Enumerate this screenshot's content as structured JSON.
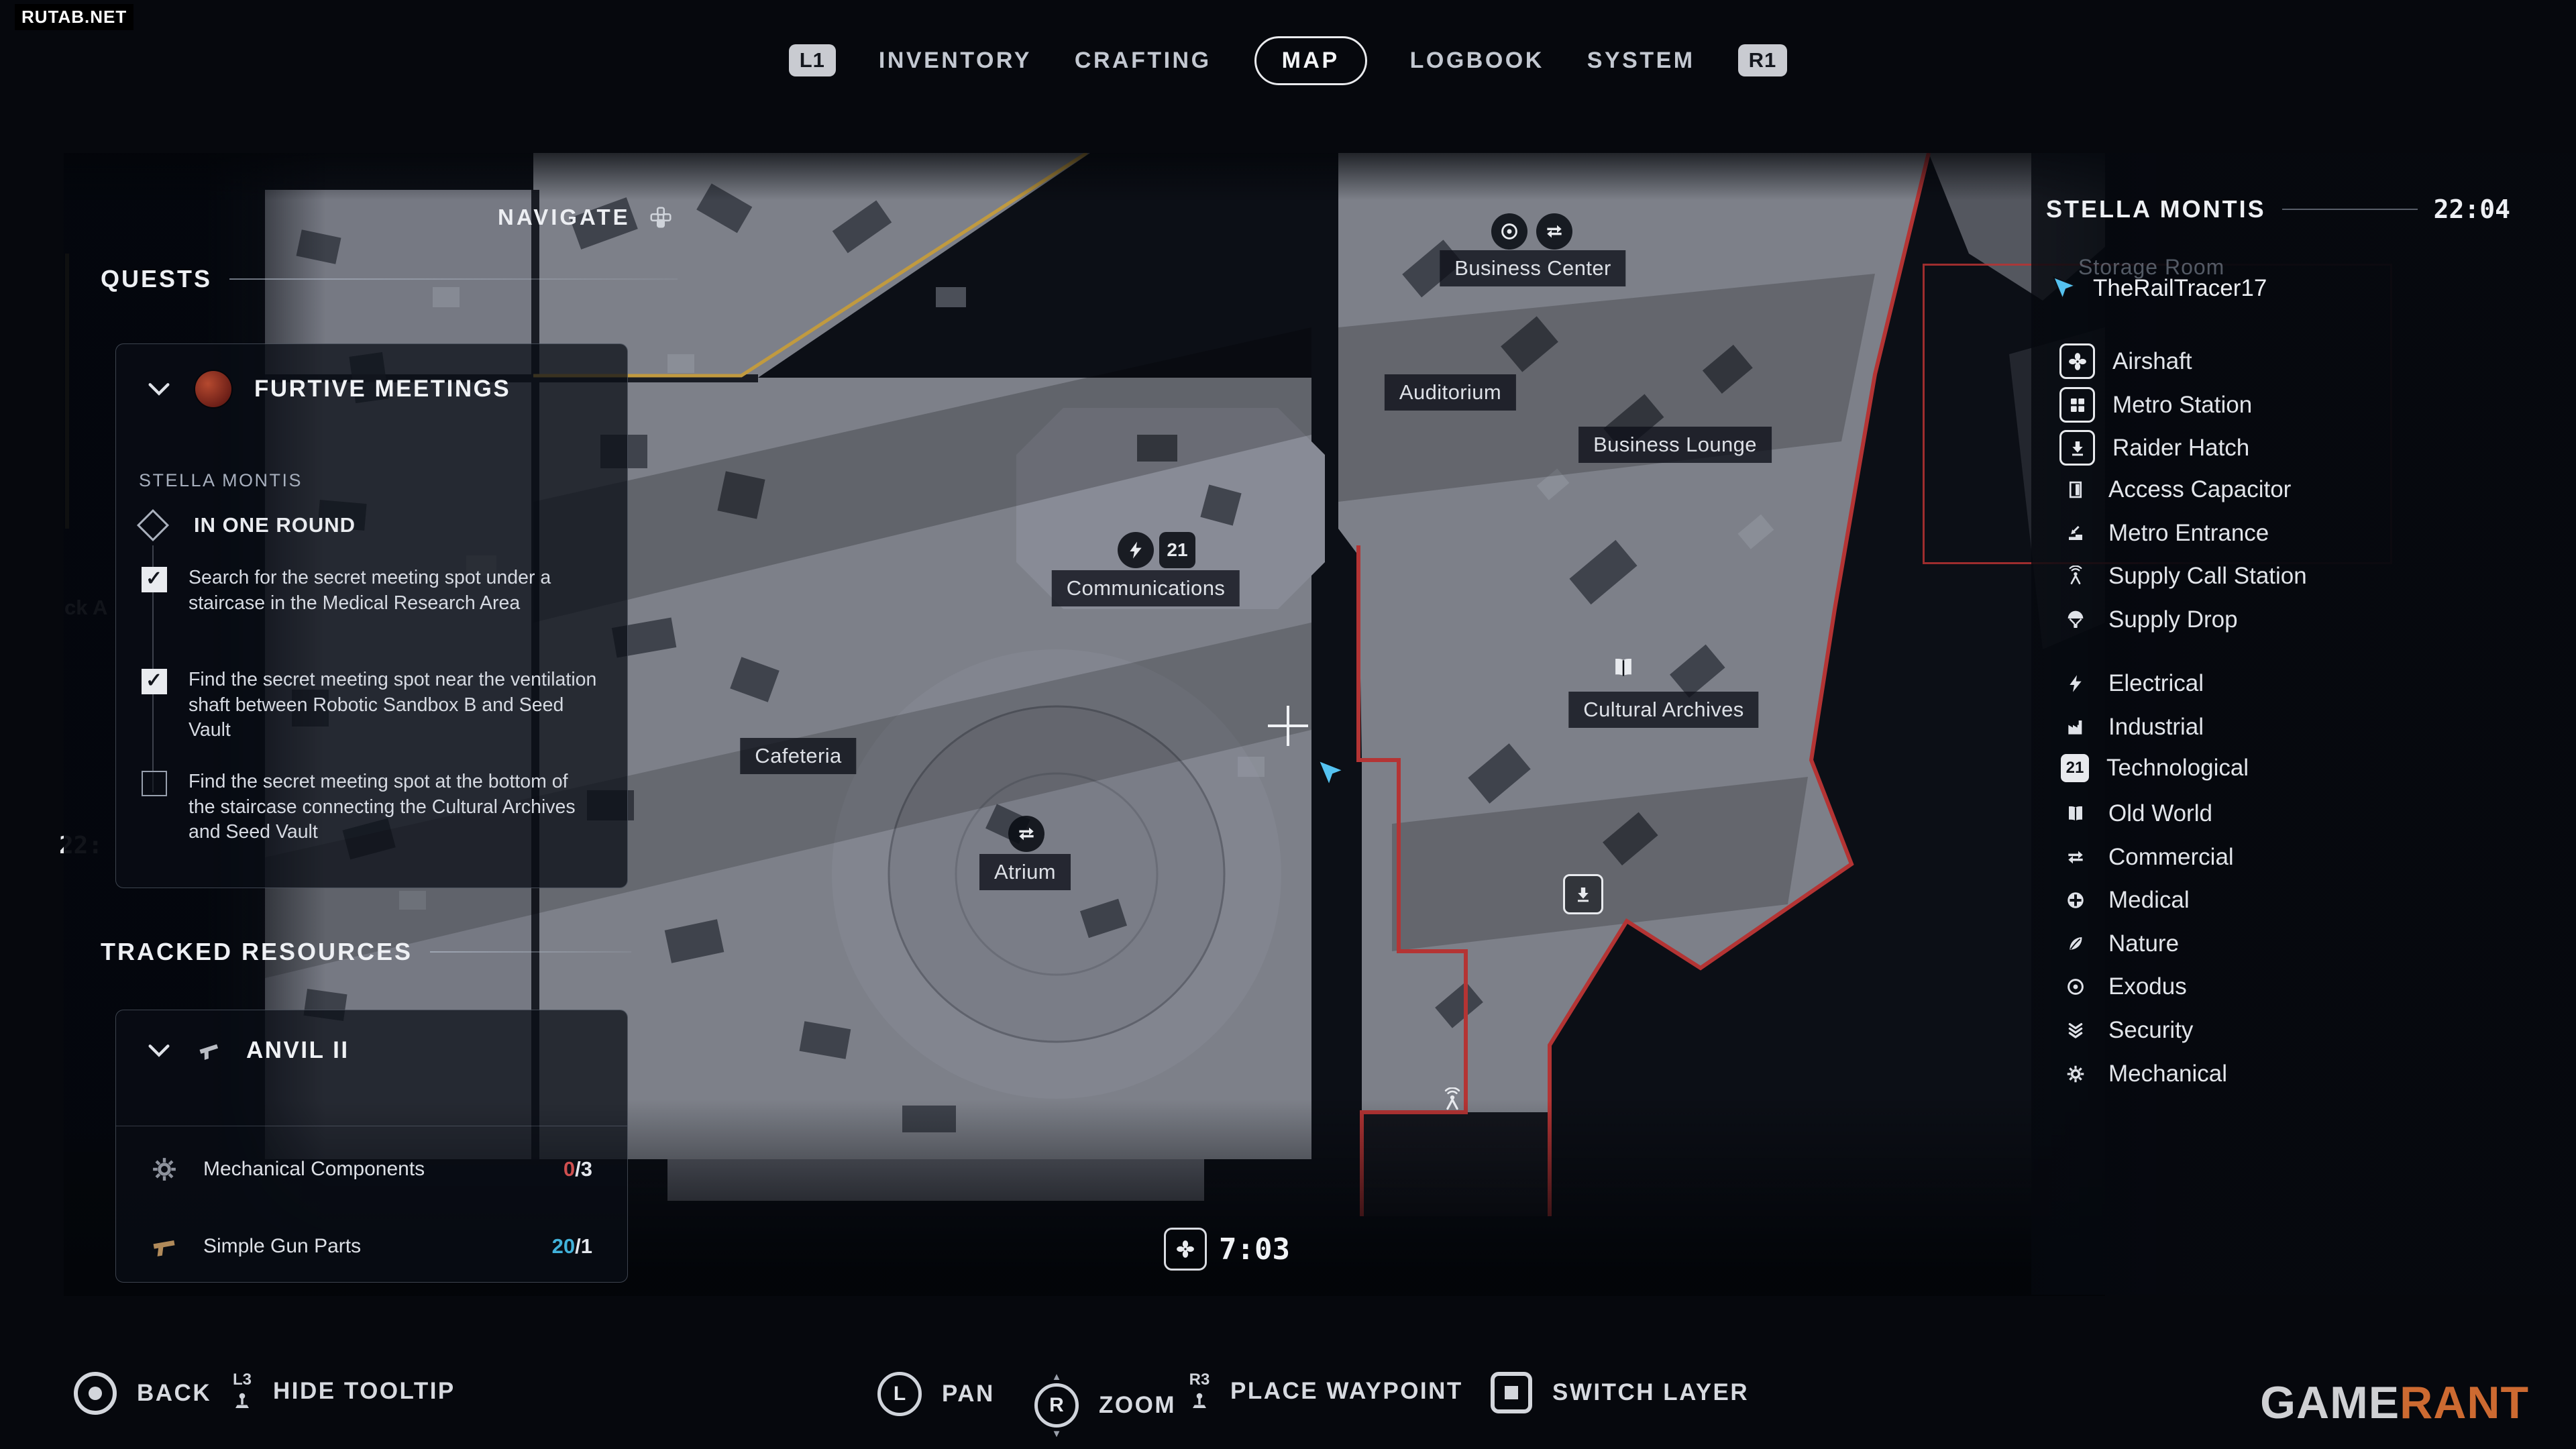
{
  "watermarks": {
    "site": "RUTAB.NET",
    "brand_bold": "GAME",
    "brand_light": "RANT"
  },
  "top_nav": {
    "left_bumper": "L1",
    "right_bumper": "R1",
    "tabs": [
      {
        "label": "INVENTORY",
        "active": false
      },
      {
        "label": "CRAFTING",
        "active": false
      },
      {
        "label": "MAP",
        "active": true
      },
      {
        "label": "LOGBOOK",
        "active": false
      },
      {
        "label": "SYSTEM",
        "active": false
      }
    ]
  },
  "map": {
    "navigate_label": "NAVIGATE",
    "timer": "7:03",
    "tech_icon_text": "21",
    "labels": [
      "Business Center",
      "Auditorium",
      "Business Lounge",
      "Communications",
      "Cafeteria",
      "Atrium",
      "Cultural Archives"
    ],
    "partial_labels": [
      "ck A",
      "22:"
    ],
    "colors": {
      "boundary_red": "#b43434",
      "boundary_yellow": "#c19a3f",
      "cursor_cyan": "#55c2f0"
    }
  },
  "quests_panel": {
    "section_title": "QUESTS",
    "quest_name": "FURTIVE MEETINGS",
    "location": "STELLA MONTIS",
    "stage": "IN ONE ROUND",
    "objectives": [
      {
        "text": "Search for the secret meeting spot under a staircase in the Medical Research Area",
        "done": true
      },
      {
        "text": "Find the secret meeting spot near the ventilation shaft between Robotic Sandbox B and Seed Vault",
        "done": true
      },
      {
        "text": "Find the secret meeting spot at the bottom of the staircase connecting the Cultural Archives and Seed Vault",
        "done": false
      }
    ]
  },
  "tracked_resources": {
    "section_title": "TRACKED RESOURCES",
    "group_name": "ANVIL II",
    "items": [
      {
        "name": "Mechanical Components",
        "have": "0",
        "need": "/3",
        "state": "missing"
      },
      {
        "name": "Simple Gun Parts",
        "have": "20",
        "need": "/1",
        "state": "ok"
      }
    ]
  },
  "right_panel": {
    "region": "STELLA MONTIS",
    "time": "22:04",
    "background_label": "Storage Room",
    "player": "TheRailTracer17",
    "legend": [
      {
        "icon": "fan-icon",
        "label": "Airshaft"
      },
      {
        "icon": "grid-icon",
        "label": "Metro Station"
      },
      {
        "icon": "hatch-icon",
        "label": "Raider Hatch"
      },
      {
        "icon": "door-icon",
        "label": "Access Capacitor"
      },
      {
        "icon": "corner-arrow-icon",
        "label": "Metro Entrance"
      },
      {
        "icon": "antenna-icon",
        "label": "Supply Call Station"
      },
      {
        "icon": "parachute-icon",
        "label": "Supply Drop"
      },
      {
        "icon": "bolt-icon",
        "label": "Electrical"
      },
      {
        "icon": "factory-icon",
        "label": "Industrial"
      },
      {
        "icon": "tech-icon",
        "label": "Technological",
        "icon_text": "21"
      },
      {
        "icon": "book-icon",
        "label": "Old World"
      },
      {
        "icon": "swap-arrows-icon",
        "label": "Commercial"
      },
      {
        "icon": "medical-cross-icon",
        "label": "Medical"
      },
      {
        "icon": "leaf-icon",
        "label": "Nature"
      },
      {
        "icon": "eye-icon",
        "label": "Exodus"
      },
      {
        "icon": "chevrons-icon",
        "label": "Security"
      },
      {
        "icon": "gear-icon",
        "label": "Mechanical"
      }
    ]
  },
  "bottom_bar": {
    "actions": [
      {
        "key": "circle",
        "label": "BACK"
      },
      {
        "key": "L3",
        "label": "HIDE TOOLTIP"
      },
      {
        "key": "L",
        "label": "PAN"
      },
      {
        "key": "R",
        "label": "ZOOM"
      },
      {
        "key": "R3",
        "label": "PLACE WAYPOINT"
      },
      {
        "key": "square",
        "label": "SWITCH LAYER"
      }
    ]
  }
}
